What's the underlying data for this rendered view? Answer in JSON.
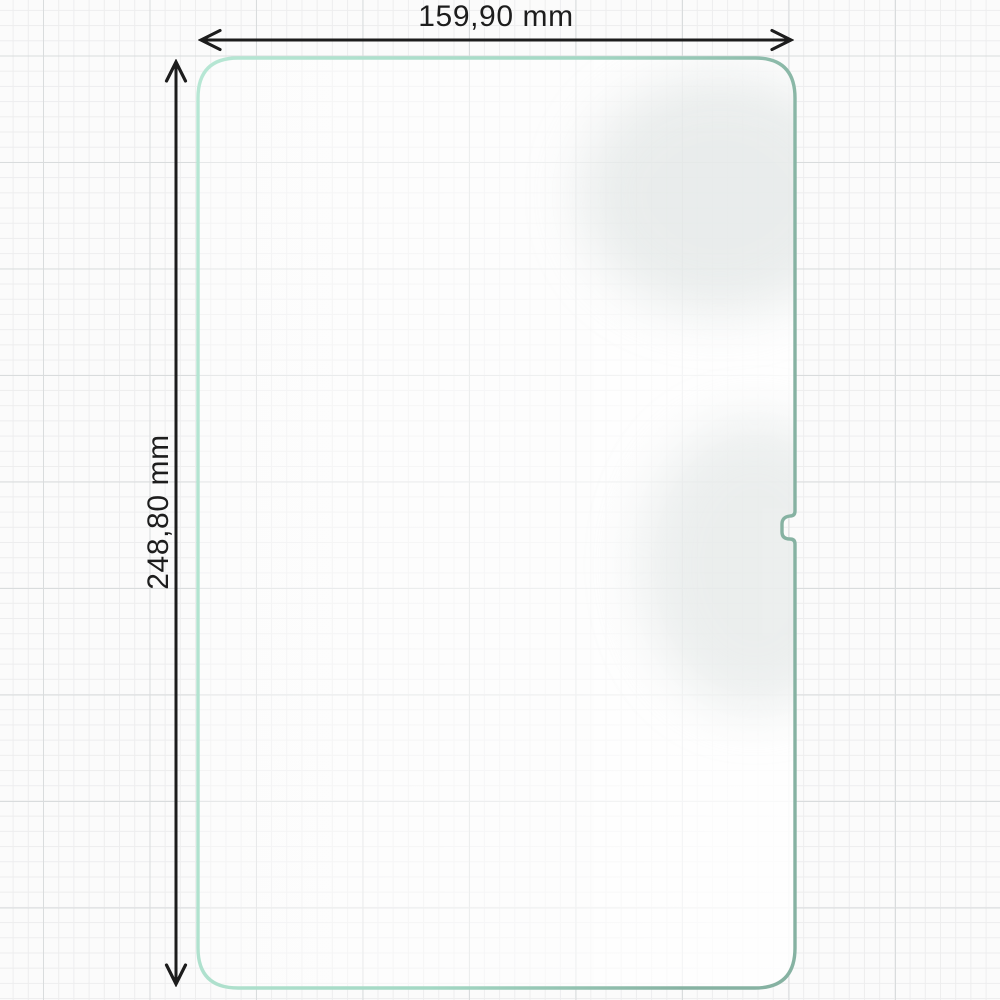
{
  "diagram": {
    "subject": "tablet screen protector outline on graph paper",
    "width_dimension": {
      "label": "159,90 mm",
      "value": "159,90",
      "unit": "mm"
    },
    "height_dimension": {
      "label": "248,80 mm",
      "value": "248,80",
      "unit": "mm"
    }
  },
  "icons": {
    "width_arrow": "double-headed-horizontal-arrow",
    "height_arrow": "double-headed-vertical-arrow"
  },
  "colors": {
    "background": "#fbfbfb",
    "grid_minor": "#ededee",
    "grid_major": "#d9dcdd",
    "outline_mint_light": "#b7e7d4",
    "outline_mint_dark": "#86b2a2",
    "dimension_line": "#1d1d1d",
    "film_highlight": "#ffffff",
    "film_shading": "#d9dfde"
  }
}
